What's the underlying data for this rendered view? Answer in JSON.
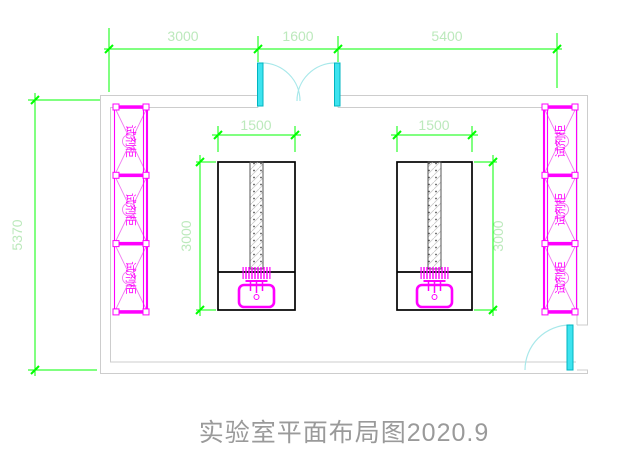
{
  "drawing": {
    "title": "实验室平面布局图2020.9"
  },
  "dimensions": {
    "top_left_bay": "3000",
    "entrance_opening": "1600",
    "top_right_bay": "5400",
    "room_depth": "5370",
    "bench_left_width": "1500",
    "bench_left_length": "3000",
    "bench_right_width": "1500",
    "bench_right_length": "3000"
  },
  "cabinets": {
    "label": "试剂柜",
    "left_count": 3,
    "right_count": 3
  },
  "colors": {
    "dimension_line": "#00ff00",
    "dimension_text": "#bce9bc",
    "wall": "#cdcdcd",
    "bench": "#000000",
    "cabinet": "#ff00ff",
    "cabinet_light": "#f07af0",
    "door": "#3ee3ef",
    "door_arc": "#a8e8ea",
    "title_text": "#9a9a9a",
    "background": "#ffffff"
  }
}
